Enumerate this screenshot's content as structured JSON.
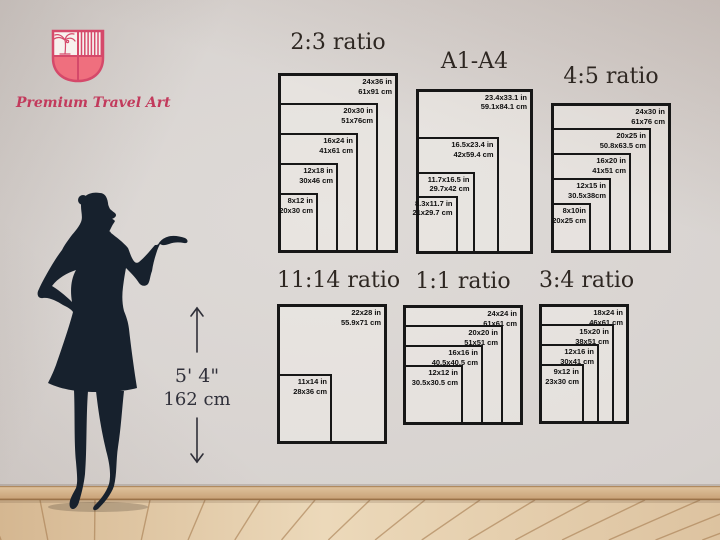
{
  "brand": {
    "name": "Premium Travel Art",
    "logo_icon": "shield-palm-tree-icon",
    "accent_color": "#d5496a",
    "fill_color": "#ef6f7e",
    "text_color": "#c23a5c"
  },
  "figure": {
    "description": "woman silhouette presenting with hand on hip",
    "color": "#17212d"
  },
  "height_marker": {
    "feet_inches": "5' 4\"",
    "centimeters": "162 cm"
  },
  "scene_colors": {
    "wall": "#d7d2cf",
    "baseboard": "#cda97e",
    "floor": "#e5d1b2",
    "floor_seam": "#a87e52",
    "rect_border": "#171717"
  },
  "charts": [
    {
      "id": "2-3",
      "title": "2:3 ratio",
      "sizes": [
        {
          "inches": "24x36 in",
          "cm": "61x91 cm",
          "w_in": 24,
          "h_in": 36
        },
        {
          "inches": "20x30 in",
          "cm": "51x76cm",
          "w_in": 20,
          "h_in": 30
        },
        {
          "inches": "16x24 in",
          "cm": "41x61 cm",
          "w_in": 16,
          "h_in": 24
        },
        {
          "inches": "12x18 in",
          "cm": "30x46 cm",
          "w_in": 12,
          "h_in": 18
        },
        {
          "inches": "8x12 in",
          "cm": "20x30 cm",
          "w_in": 8,
          "h_in": 12
        }
      ]
    },
    {
      "id": "a1-a4",
      "title": "A1-A4",
      "sizes": [
        {
          "inches": "23.4x33.1 in",
          "cm": "59.1x84.1 cm",
          "w_in": 23.4,
          "h_in": 33.1
        },
        {
          "inches": "16.5x23.4 in",
          "cm": "42x59.4 cm",
          "w_in": 16.5,
          "h_in": 23.4
        },
        {
          "inches": "11.7x16.5 in",
          "cm": "29.7x42 cm",
          "w_in": 11.7,
          "h_in": 16.5
        },
        {
          "inches": "8.3x11.7 in",
          "cm": "21x29.7 cm",
          "w_in": 8.3,
          "h_in": 11.7
        }
      ]
    },
    {
      "id": "4-5",
      "title": "4:5 ratio",
      "sizes": [
        {
          "inches": "24x30 in",
          "cm": "61x76 cm",
          "w_in": 24,
          "h_in": 30
        },
        {
          "inches": "20x25 in",
          "cm": "50.8x63.5 cm",
          "w_in": 20,
          "h_in": 25
        },
        {
          "inches": "16x20 in",
          "cm": "41x51 cm",
          "w_in": 16,
          "h_in": 20
        },
        {
          "inches": "12x15 in",
          "cm": "30.5x38cm",
          "w_in": 12,
          "h_in": 15
        },
        {
          "inches": "8x10in",
          "cm": "20x25 cm",
          "w_in": 8,
          "h_in": 10
        }
      ]
    },
    {
      "id": "11-14",
      "title": "11:14 ratio",
      "sizes": [
        {
          "inches": "22x28 in",
          "cm": "55.9x71 cm",
          "w_in": 22,
          "h_in": 28
        },
        {
          "inches": "11x14 in",
          "cm": "28x36 cm",
          "w_in": 11,
          "h_in": 14
        }
      ]
    },
    {
      "id": "1-1",
      "title": "1:1 ratio",
      "sizes": [
        {
          "inches": "24x24 in",
          "cm": "61x61 cm",
          "w_in": 24,
          "h_in": 24
        },
        {
          "inches": "20x20 in",
          "cm": "51x51 cm",
          "w_in": 20,
          "h_in": 20
        },
        {
          "inches": "16x16 in",
          "cm": "40.5x40.5 cm",
          "w_in": 16,
          "h_in": 16
        },
        {
          "inches": "12x12 in",
          "cm": "30.5x30.5 cm",
          "w_in": 12,
          "h_in": 12
        }
      ]
    },
    {
      "id": "3-4",
      "title": "3:4 ratio",
      "sizes": [
        {
          "inches": "18x24 in",
          "cm": "46x61 cm",
          "w_in": 18,
          "h_in": 24
        },
        {
          "inches": "15x20 in",
          "cm": "38x51 cm",
          "w_in": 15,
          "h_in": 20
        },
        {
          "inches": "12x16 in",
          "cm": "30x41 cm",
          "w_in": 12,
          "h_in": 16
        },
        {
          "inches": "9x12 in",
          "cm": "23x30 cm",
          "w_in": 9,
          "h_in": 12
        }
      ]
    }
  ]
}
